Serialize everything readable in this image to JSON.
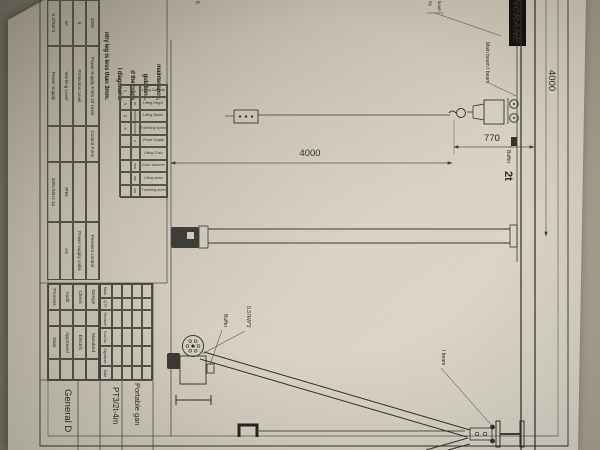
{
  "photo": {
    "table_color": "#7d7769",
    "paper_color": "#d6d0c3",
    "line_color": "#3a3832"
  },
  "logo": {
    "text": "ENCRANE"
  },
  "drawing": {
    "dim_span": "4000",
    "dim_height": "4000",
    "dim_headroom": "770",
    "capacity_label": "2t",
    "buffer_label_1": "Buffer",
    "buffer_label_2": "Buffer",
    "motor_label": "0.37kW*2",
    "main_beam_label": "Main beam I beam",
    "i_beam_label": "I beam",
    "fragment_label_1": "beam",
    "fragment_label_2": "ng",
    "fragment_note": "6."
  },
  "notes": {
    "lines": [
      "maintenance,",
      "gulations.",
      "d the crane",
      "l diagonal is",
      "ntry leg is less than 3mm."
    ]
  },
  "spec_table": {
    "headers": [
      "Lifting Capacity",
      "Lifting Height",
      "Lifting Speed",
      "Travelling Speed",
      "Power Supply",
      "Lifting Chain",
      "Chain diameter",
      "Lifting motor",
      "Travelling motor"
    ],
    "units": [
      "t",
      "m",
      "m/min",
      "m/min",
      "v",
      "",
      "mm",
      "kw",
      "kw"
    ],
    "values": [
      "2",
      "3",
      "8",
      "8",
      "",
      "",
      "",
      "",
      ""
    ]
  },
  "info_table": {
    "rows": [
      [
        "2000",
        "Power Supply Form Of Hoist",
        "Control Form",
        "",
        "Pendent control"
      ],
      [
        "6",
        "Protection Level",
        "",
        "",
        "Power supply cable"
      ],
      [
        "10",
        "Working Level",
        "",
        "IP54",
        "A3"
      ],
      [
        "0.37kw*2",
        "Power Supply",
        "",
        "220v 50Hz 1p",
        ""
      ]
    ]
  },
  "title_block": {
    "revision_headers": [
      "Mark",
      "QTY",
      "Revised",
      "Doc.No",
      "Signature",
      "Date"
    ],
    "approvals": [
      [
        "Design",
        "Standard"
      ],
      [
        "Check",
        "Electric"
      ],
      [
        "Audit",
        "Approved"
      ],
      [
        "Process",
        "Date"
      ]
    ],
    "project_title": "Portable gan",
    "model": "PT3/2t-4m",
    "doc_type": "General D"
  }
}
